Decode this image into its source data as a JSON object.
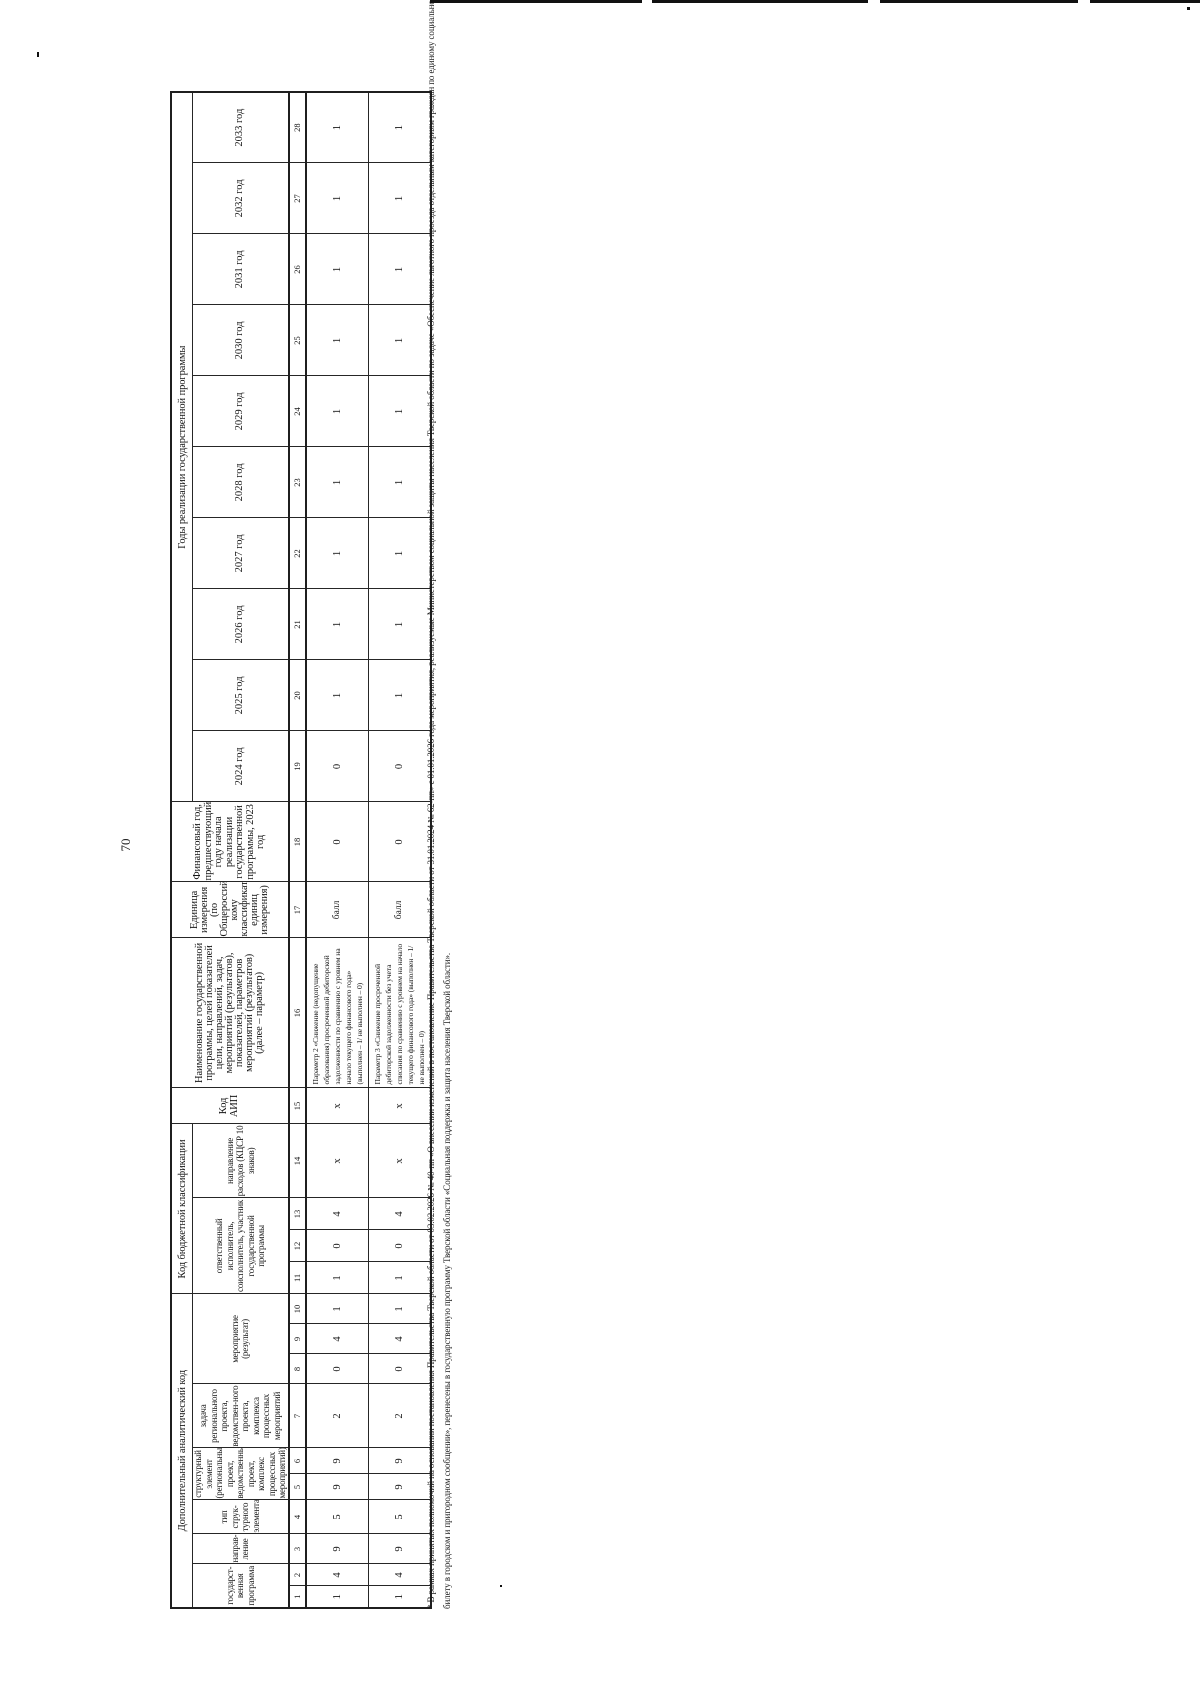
{
  "page": {
    "number": "70"
  },
  "table": {
    "group_headers": {
      "analytic_code": "Дополнительный аналитический код",
      "budget_class": "Код бюджетной классификации",
      "years_banner": "Годы реализации государственной программы"
    },
    "sub_headers": {
      "state_program": "государст-венная программа",
      "direction": "направ-ление",
      "element_type": "тип струк-турного элемента",
      "structural_element": "структурный элемент (региональный проект, ведомственный проект, комплекс процессных мероприятий)",
      "task": "задача регионального проекта, ведомствен-ного проекта, комплекса процессных мероприятий",
      "event": "мероприятие (результат)",
      "executor": "ответственный исполнитель, соисполнитель, участник государственной программы",
      "expense_direction": "направление расходов (КЦСР 10 знаков)",
      "aip_code": "Код АИП",
      "name": "Наименование государственной программы, целей показателей цели, направлений, задач, мероприятий (результатов), показателей, параметров мероприятий (результатов) (далее – параметр)",
      "unit": "Единица измерения (по Общероссийс-кому классификатору единиц измерения)",
      "base_year": "Финансовый год, предшествующий году начала реализации государственной программы, 2023 год"
    },
    "years": [
      "2024 год",
      "2025 год",
      "2026 год",
      "2027 год",
      "2028 год",
      "2029 год",
      "2030 год",
      "2031 год",
      "2032 год",
      "2033 год"
    ],
    "numbering": [
      "1",
      "2",
      "3",
      "4",
      "5",
      "6",
      "7",
      "8",
      "9",
      "10",
      "11",
      "12",
      "13",
      "14",
      "15",
      "16",
      "17",
      "18",
      "19",
      "20",
      "21",
      "22",
      "23",
      "24",
      "25",
      "26",
      "27",
      "28"
    ],
    "rows": [
      {
        "cells": [
          "1",
          "4",
          "9",
          "5",
          "9",
          "9",
          "2",
          "0",
          "4",
          "1",
          "1",
          "0",
          "4",
          "х",
          "х",
          "Параметр 2 «Снижение (недопущение образования) просроченной дебиторской задолженности по сравнению с уровнем на начало текущего финансового года» (выполнен – 1/ не выполнен – 0)",
          "балл",
          "0",
          "0",
          "1",
          "1",
          "1",
          "1",
          "1",
          "1",
          "1",
          "1",
          "1"
        ]
      },
      {
        "cells": [
          "1",
          "4",
          "9",
          "5",
          "9",
          "9",
          "2",
          "0",
          "4",
          "1",
          "1",
          "0",
          "4",
          "х",
          "х",
          "Параметр 3 «Снижение просроченной дебиторской задолженности без учета списания по сравнению с уровнем на начало текущего финансового года» (выполнен – 1/не выполнен – 0)",
          "балл",
          "0",
          "0",
          "1",
          "1",
          "1",
          "1",
          "1",
          "1",
          "1",
          "1",
          "1"
        ]
      }
    ]
  },
  "footnote": {
    "line1": "* В рамках принятых полномочий на основании постановления Правительства Тверской области от 03.02.2026 № 40-пп «О внесении изменений в постановление Правительства Тверской области от 31.01.2024 № 62-пп» с 01.01.2026 года мероприятия, реализуемые Министерством социальной защиты населения Тверской области по задаче «Обеспечение льготного проезда отдельным категориям граждан по единому социальному проездному",
    "line2": "билету в городском и пригородном сообщении», перенесены в государственную программу Тверской области «Социальная поддержка и защита населения Тверской области»."
  }
}
